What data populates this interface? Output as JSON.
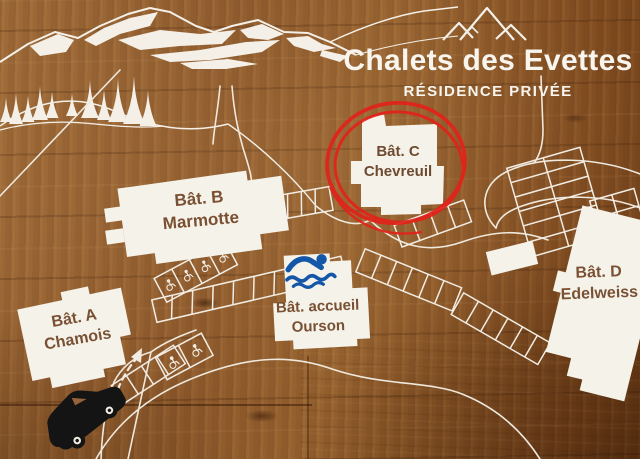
{
  "map": {
    "title": "Chalets des Evettes",
    "subtitle": "RÉSIDENCE PRIVÉE",
    "buildings": [
      {
        "name": "Bât. A",
        "sub": "Chamois"
      },
      {
        "name": "Bât. B",
        "sub": "Marmotte"
      },
      {
        "name": "Bât. C",
        "sub": "Chevreuil",
        "highlighted": true
      },
      {
        "name": "Bât. D",
        "sub": "Edelweiss"
      },
      {
        "name": "Bât. accueil",
        "sub": "Ourson"
      }
    ],
    "highlight": {
      "target": "Bât. C Chevreuil",
      "style": "hand-drawn red circle"
    },
    "icons": [
      {
        "name": "mountain-logo-icon",
        "meaning": "three mountain peaks"
      },
      {
        "name": "mountain-range",
        "meaning": "snowy mountain ridge artwork"
      },
      {
        "name": "pine-tree-icon",
        "meaning": "forest trees"
      },
      {
        "name": "swimmer-icon",
        "meaning": "swimming pool at reception building"
      },
      {
        "name": "wheelchair-icon",
        "meaning": "accessible parking space"
      },
      {
        "name": "car-icon",
        "meaning": "vehicle at entrance"
      },
      {
        "name": "entry-arrow-icon",
        "meaning": "driving direction into residence"
      }
    ],
    "colors": {
      "wood_brown": "#8f5c2e",
      "print_white": "#f4f0e8",
      "label_brown": "#7a5033",
      "highlight_red": "#e2231a",
      "pool_blue": "#1456a8",
      "car_black": "#141414"
    }
  }
}
